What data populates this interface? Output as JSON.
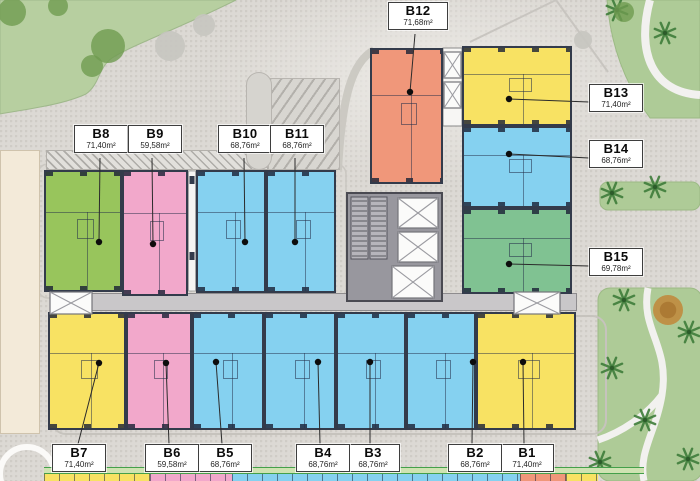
{
  "plan": {
    "kind": "apartment-floor-plan"
  },
  "labels": [
    {
      "name": "B1",
      "area": "71,40m²"
    },
    {
      "name": "B2",
      "area": "68,76m²"
    },
    {
      "name": "B3",
      "area": "68,76m²"
    },
    {
      "name": "B4",
      "area": "68,76m²"
    },
    {
      "name": "B5",
      "area": "68,76m²"
    },
    {
      "name": "B6",
      "area": "59,58m²"
    },
    {
      "name": "B7",
      "area": "71,40m²"
    },
    {
      "name": "B8",
      "area": "71,40m²"
    },
    {
      "name": "B9",
      "area": "59,58m²"
    },
    {
      "name": "B10",
      "area": "68,76m²"
    },
    {
      "name": "B11",
      "area": "68,76m²"
    },
    {
      "name": "B12",
      "area": "71,68m²"
    },
    {
      "name": "B13",
      "area": "71,40m²"
    },
    {
      "name": "B14",
      "area": "68,76m²"
    },
    {
      "name": "B15",
      "area": "69,78m²"
    }
  ],
  "colors": {
    "unit_fills": {
      "yellow": "#f8e263",
      "pink": "#f2a8cb",
      "blue": "#85d1f0",
      "green": "#98c55c",
      "green2": "#80c292",
      "salmon": "#f0977a"
    },
    "lawn": "#b7cfa0",
    "garden": "#aecb97",
    "pavement": "#dcd9d4",
    "core_gray": "#98979e",
    "corridor_gray": "#c9c7c9",
    "band_green": "#44a04a",
    "leader_line": "#2b2b2b"
  },
  "floorplan": {
    "units": [
      {
        "id": "B8",
        "x": 44,
        "y": 170,
        "w": 78,
        "h": 122,
        "c": "green"
      },
      {
        "id": "B9",
        "x": 122,
        "y": 170,
        "w": 66,
        "h": 126,
        "c": "pink"
      },
      {
        "id": "B10",
        "x": 196,
        "y": 170,
        "w": 70,
        "h": 123,
        "c": "blue"
      },
      {
        "id": "B11",
        "x": 266,
        "y": 170,
        "w": 70,
        "h": 123,
        "c": "blue"
      },
      {
        "id": "B12",
        "x": 370,
        "y": 48,
        "w": 73,
        "h": 136,
        "c": "salmon"
      },
      {
        "id": "B13",
        "x": 462,
        "y": 46,
        "w": 110,
        "h": 80,
        "c": "yellow"
      },
      {
        "id": "B14",
        "x": 462,
        "y": 126,
        "w": 110,
        "h": 82,
        "c": "blue"
      },
      {
        "id": "B15",
        "x": 462,
        "y": 208,
        "w": 110,
        "h": 86,
        "c": "green2"
      },
      {
        "id": "B7",
        "x": 48,
        "y": 312,
        "w": 78,
        "h": 118,
        "c": "yellow"
      },
      {
        "id": "B6",
        "x": 126,
        "y": 312,
        "w": 66,
        "h": 118,
        "c": "pink"
      },
      {
        "id": "B5",
        "x": 192,
        "y": 312,
        "w": 72,
        "h": 118,
        "c": "blue"
      },
      {
        "id": "B4",
        "x": 264,
        "y": 312,
        "w": 72,
        "h": 118,
        "c": "blue"
      },
      {
        "id": "B3",
        "x": 336,
        "y": 312,
        "w": 70,
        "h": 118,
        "c": "blue"
      },
      {
        "id": "B2",
        "x": 406,
        "y": 312,
        "w": 70,
        "h": 118,
        "c": "blue"
      },
      {
        "id": "B1",
        "x": 476,
        "y": 312,
        "w": 100,
        "h": 118,
        "c": "yellow"
      }
    ],
    "leaders": [
      [
        100,
        158,
        99,
        242
      ],
      [
        152,
        158,
        153,
        244
      ],
      [
        244,
        158,
        245,
        242
      ],
      [
        295,
        158,
        295,
        242
      ],
      [
        415,
        34,
        410,
        92
      ],
      [
        589,
        102,
        509,
        99
      ],
      [
        589,
        158,
        509,
        154
      ],
      [
        589,
        266,
        509,
        264
      ],
      [
        78,
        444,
        99,
        363
      ],
      [
        169,
        444,
        166,
        363
      ],
      [
        222,
        444,
        216,
        362
      ],
      [
        320,
        444,
        318,
        362
      ],
      [
        370,
        444,
        370,
        362
      ],
      [
        472,
        444,
        473,
        362
      ],
      [
        524,
        444,
        523,
        362
      ]
    ],
    "xboxes": [
      [
        50,
        292,
        42,
        22
      ],
      [
        514,
        292,
        46,
        22
      ],
      [
        444,
        52,
        17,
        26
      ],
      [
        444,
        82,
        17,
        26
      ],
      [
        398,
        198,
        40,
        30
      ],
      [
        398,
        232,
        40,
        30
      ],
      [
        392,
        266,
        42,
        32
      ]
    ],
    "stairs": [
      [
        351,
        197,
        17,
        62
      ],
      [
        370,
        197,
        17,
        62
      ]
    ],
    "palms": [
      [
        617,
        10
      ],
      [
        665,
        33
      ],
      [
        612,
        193
      ],
      [
        655,
        187
      ],
      [
        624,
        300
      ],
      [
        689,
        332
      ],
      [
        612,
        368
      ],
      [
        645,
        420
      ],
      [
        688,
        459
      ],
      [
        600,
        462
      ]
    ],
    "bushes": [
      [
        12,
        12,
        14
      ],
      [
        58,
        6,
        10
      ],
      [
        108,
        46,
        17
      ],
      [
        92,
        66,
        11
      ],
      [
        624,
        12,
        10
      ]
    ],
    "gray_trees": [
      [
        170,
        46,
        15
      ],
      [
        204,
        25,
        11
      ],
      [
        583,
        40,
        9
      ]
    ],
    "brown_tree": [
      668,
      310,
      15
    ],
    "strip_blocks": [
      {
        "x": 44,
        "w": 106,
        "c": "yellow"
      },
      {
        "x": 150,
        "w": 82,
        "c": "pink"
      },
      {
        "x": 232,
        "w": 288,
        "c": "blue"
      },
      {
        "x": 520,
        "w": 46,
        "c": "salmon"
      },
      {
        "x": 566,
        "w": 32,
        "c": "yellow"
      }
    ]
  }
}
